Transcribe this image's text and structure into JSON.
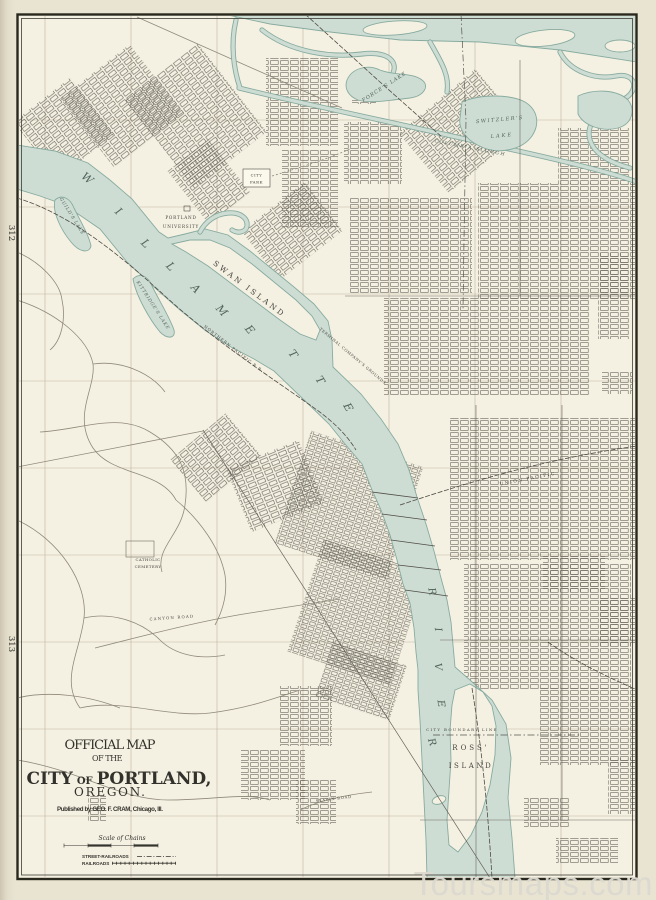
{
  "page": {
    "left_margin_numbers": [
      "312",
      "313"
    ],
    "watermark": "Toursmaps.com"
  },
  "title_block": {
    "line1": "OFFICIAL MAP",
    "line2": "OF THE",
    "line3_city": "CITY",
    "line3_of": "OF",
    "line3_name": "PORTLAND,",
    "line4": "OREGON.",
    "publisher": "Published by GEO. F. CRAM, Chicago, Ill."
  },
  "scale": {
    "label": "Scale of Chains"
  },
  "legend": {
    "street_railroads": "STREET-RAILROADS",
    "railroads": "RAILROADS"
  },
  "water_labels": {
    "willamette": "WILLAMETTE",
    "river": "RIVER",
    "columbia_slough": "COLUMBIA SLOUGH",
    "forces_lake": "FORCE'S LAKE",
    "switzlers_lake_line1": "SWITZLER'S",
    "switzlers_lake_line2": "LAKE",
    "guilds_lake": "GUILD'S LAKE",
    "kittridges_lake": "KITTRIDGE'S LAKE"
  },
  "place_labels": {
    "swan_island": "SWAN ISLAND",
    "ross_island_line1": "ROSS'",
    "ross_island_line2": "ISLAND",
    "portland_university_line1": "PORTLAND",
    "portland_university_line2": "UNIVERSITY",
    "city_park_line1": "CITY",
    "city_park_line2": "PARK",
    "catholic_cemetery_line1": "CATHOLIC",
    "catholic_cemetery_line2": "CEMETERY",
    "city_boundary_line": "CITY BOUNDARY LINE",
    "union_pacific": "UNION PACIFIC",
    "northern_pacific": "NORTHERN PACIFIC R.R.",
    "terminal_grounds": "TERMINAL COMPANY'S GROUNDS",
    "canyon_road": "CANYON ROAD",
    "slavin_road": "SLAVIN ROAD"
  },
  "colors": {
    "page_background": "#e9e3d2",
    "map_background": "#f5f1e2",
    "water_fill": "#cedde0",
    "water_fill_exact": "#ceddd4",
    "water_outline": "#87aba0",
    "ink": "#3c3b36",
    "section_line": "#b9ae9a",
    "watermark": "#dcd9d0"
  }
}
